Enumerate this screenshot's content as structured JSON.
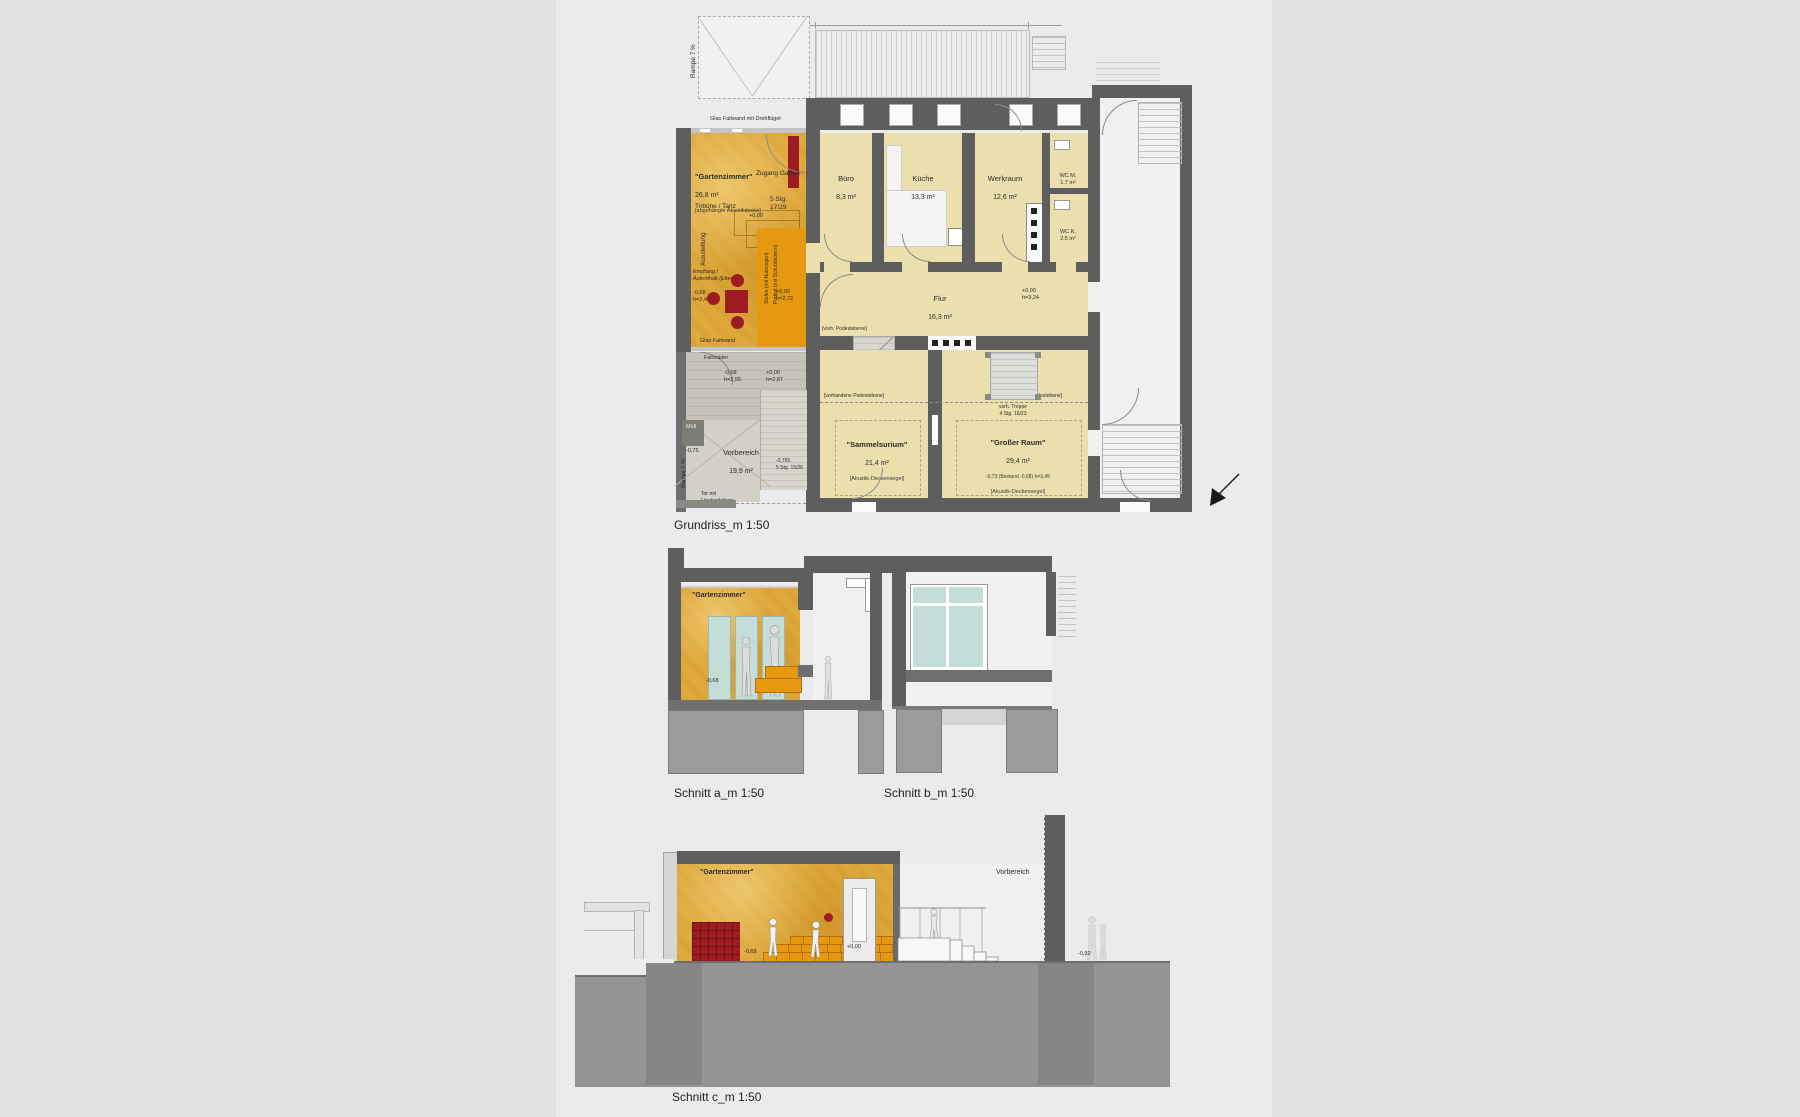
{
  "colors": {
    "background": "#e2e2e4",
    "panel": "#ebebed",
    "wall": "#5e5e5e",
    "room_fill": "#ecdfae",
    "gartenzimmer_ochre": "#dfa93c",
    "podest_orange": "#e6990f",
    "accent_red": "#9c1c22",
    "glass": "#c5ddd8",
    "vestibule": "#c8c3b8",
    "ground": "#949494"
  },
  "plan": {
    "caption": "Grundriss_m 1:50",
    "rooms": {
      "gartenzimmer": {
        "name": "\"Gartenzimmer\"",
        "area": "26,8 m²",
        "note": "[abgehängte Akustikdecke]"
      },
      "buero": {
        "name": "Büro",
        "area": "8,3 m²"
      },
      "kueche": {
        "name": "Küche",
        "area": "13,3 m²"
      },
      "werkraum": {
        "name": "Werkraum",
        "area": "12,6 m²"
      },
      "wc_m": {
        "name": "WC M.",
        "area": "1,7 m²"
      },
      "wc_k": {
        "name": "WC K.",
        "area": "2,5 m²"
      },
      "flur": {
        "name": "Flur",
        "area": "16,3 m²"
      },
      "sammelsurium": {
        "name": "\"Sammelsurium\"",
        "area": "21,4 m²",
        "note": "[Akustik-Deckensegel]"
      },
      "grosser_raum": {
        "name": "\"Großer Raum\"",
        "area": "29,4 m²",
        "note": "[Akustik-Deckensegel]"
      },
      "vorbereich": {
        "name": "Vorbereich",
        "area": "19,9 m²"
      }
    },
    "ann": {
      "glas_faltwand_oben": "Glas Faltwand mit Drehflügel",
      "zugang_garten": "Zugang Garten",
      "tribuene": "Tribüne / Tanz",
      "ausstellung": "Ausstellung",
      "empfang": "Empfang /\nAufenthalt (Eltern)",
      "level_gz": "-0,68\nh=2,40",
      "level_podest": "+0,00\nh=2,72",
      "stg_gz": "5 Stg.\n17/29",
      "plus_null": "+0,00",
      "glas_faltwand": "Glas Faltwand",
      "fahrraeder": "Fahrräder",
      "stufen": "Stufen (mit Nutzungen)",
      "podest": "Podest (mit Schubfächern)",
      "vorh_podestebene": "[vorh. Podestebene]",
      "level_flur": "+0,00\nh=3,24",
      "vorhandene_podestebene": "[vorhandene Podestebene]",
      "vorh_treppe": "vorh. Treppe\n4 Stg. 16/23",
      "level_gross": "-0,73 (Bestand -0,68)  h=3,45",
      "level_vb1": "-0,68\nh=2,55",
      "level_vb2": "+0,00\nh=2,87",
      "muell": "Müll",
      "level_muell": "-0,75",
      "rampe": "Rampe 7 %",
      "tor": "Tor mit\nLärchenlattung",
      "stg_vb": "-0,765\n5 Stg. 15/26"
    }
  },
  "sections": {
    "a": {
      "caption": "Schnitt a_m 1:50",
      "room": "\"Gartenzimmer\"",
      "level": "-0,68"
    },
    "b": {
      "caption": "Schnitt b_m 1:50"
    },
    "c": {
      "caption": "Schnitt c_m 1:50",
      "room": "\"Gartenzimmer\"",
      "vorbereich": "Vorbereich",
      "level_door": "+0,00",
      "level_floor": "-0,68",
      "level_ground": "-0,92"
    }
  }
}
